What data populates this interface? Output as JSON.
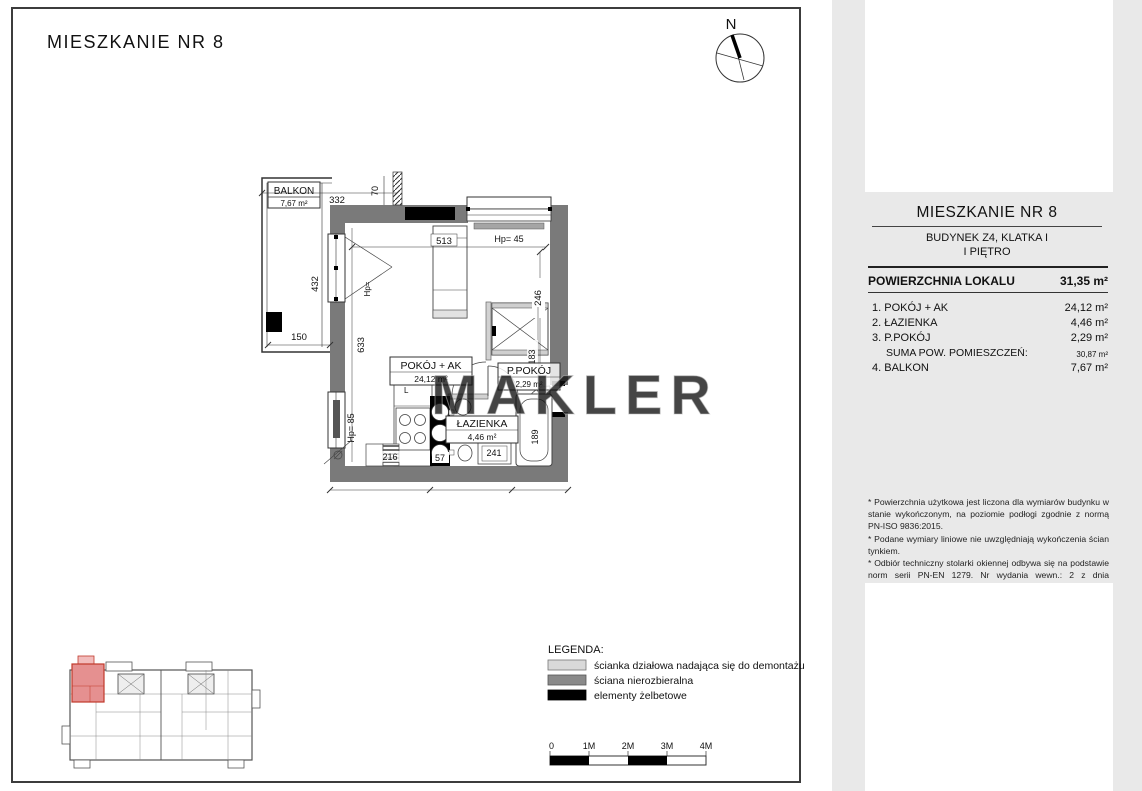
{
  "drawing": {
    "title": "MIESZKANIE NR 8",
    "north_label": "N",
    "watermark": "MAKLER",
    "balcony": {
      "name": "BALKON",
      "area": "7,67 m²"
    },
    "rooms": [
      {
        "name": "POKÓJ + AK",
        "area": "24,12 m²"
      },
      {
        "name": "ŁAZIENKA",
        "area": "4,46 m²"
      },
      {
        "name": "P.POKÓJ",
        "area": "2,29 m²"
      }
    ],
    "dims": {
      "balcony_width": "332",
      "wall_offset": "70",
      "balcony_height": "432",
      "balcony_bottom": "150",
      "room_left": "633",
      "room_top": "513",
      "room_right": "246",
      "hall": "183",
      "bath_right": "189",
      "kitchen": "216",
      "shaft": "57",
      "bath_bottom": "241"
    },
    "window_params": {
      "top": "Hp= 45",
      "left": "Hp= 85",
      "balcony_door": "Hp="
    },
    "fridge_label": "L"
  },
  "legend": {
    "title": "LEGENDA:",
    "items": [
      {
        "label": "ścianka działowa nadająca się do demontażu",
        "color": "#d9d9d9"
      },
      {
        "label": "ściana nierozbieralna",
        "color": "#8a8a8a"
      },
      {
        "label": "elementy żelbetowe",
        "color": "#000000"
      }
    ]
  },
  "scalebar": {
    "labels": [
      "0",
      "1M",
      "2M",
      "3M",
      "4M"
    ]
  },
  "colors": {
    "wall": "#7a7a7a",
    "partition": "#d2d2d2",
    "reinforced": "#000000",
    "unit_highlight": "#e59090",
    "panel_bg": "#e9e9e9"
  },
  "panel": {
    "title": "MIESZKANIE NR 8",
    "subtitle1": "BUDYNEK Z4, KLATKA I",
    "subtitle2": "I PIĘTRO",
    "area_label": "POWIERZCHNIA LOKALU",
    "area_value": "31,35 m²",
    "rows": [
      {
        "label": "1. POKÓJ + AK",
        "value": "24,12 m²"
      },
      {
        "label": "2. ŁAZIENKA",
        "value": "4,46 m²"
      },
      {
        "label": "3. P.POKÓJ",
        "value": "2,29 m²"
      },
      {
        "label": "SUMA POW. POMIESZCZEŃ:",
        "value": "30,87 m²"
      },
      {
        "label": "4. BALKON",
        "value": "7,67 m²"
      }
    ],
    "footnotes": [
      "* Powierzchnia użytkowa jest liczona dla wymiarów budynku w stanie wykończonym, na poziomie podłogi zgodnie z normą PN-ISO 9836:2015.",
      "* Podane wymiary liniowe nie uwzględniają wykończenia ścian tynkiem.",
      "* Odbiór techniczny stolarki okiennej odbywa się na podstawie norm serii PN-EN 1279. Nr wydania wewn.: 2 z dnia 07.01.2020 r.",
      "* Powierzchnia lokalu uwzględnia powierzchnię pod ściankami działowymi nadającymi się do demontażu."
    ]
  }
}
